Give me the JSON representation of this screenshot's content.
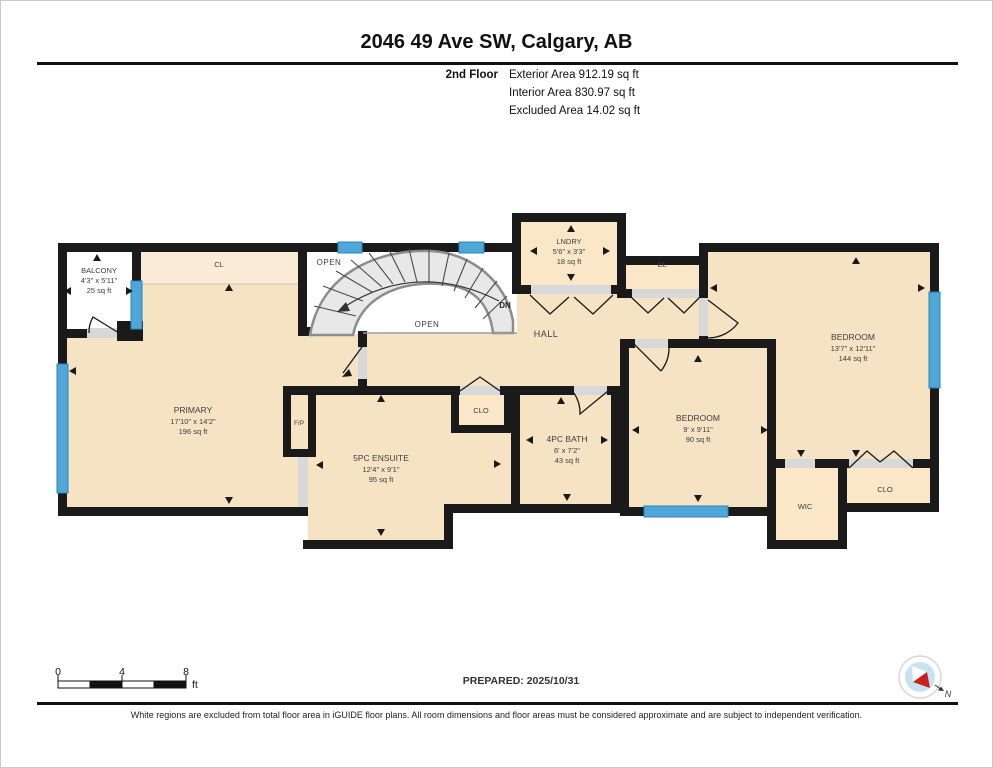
{
  "header": {
    "title": "2046 49 Ave SW, Calgary, AB",
    "floor_label": "2nd Floor",
    "exterior_area": "Exterior Area 912.19 sq ft",
    "interior_area": "Interior Area 830.97 sq ft",
    "excluded_area": "Excluded Area 14.02 sq ft"
  },
  "plan": {
    "rooms": {
      "balcony": {
        "name": "BALCONY",
        "dims": "4'3\" x 5'11\"",
        "area": "25 sq ft"
      },
      "primary": {
        "name": "PRIMARY",
        "dims": "17'10\" x 14'2\"",
        "area": "196 sq ft"
      },
      "ensuite": {
        "name": "5PC ENSUITE",
        "dims": "12'4\" x 9'1\"",
        "area": "95 sq ft"
      },
      "bath": {
        "name": "4PC BATH",
        "dims": "6' x 7'2\"",
        "area": "43 sq ft"
      },
      "bedroom_mid": {
        "name": "BEDROOM",
        "dims": "9' x 9'11\"",
        "area": "90 sq ft"
      },
      "bedroom_right": {
        "name": "BEDROOM",
        "dims": "13'7\" x 12'11\"",
        "area": "144 sq ft"
      },
      "laundry": {
        "name": "LNDRY",
        "dims": "5'6\" x 3'3\"",
        "area": "18 sq ft"
      },
      "hall": {
        "name": "HALL"
      }
    },
    "labels": {
      "cl_primary": "CL",
      "cl_hall": "CL",
      "clo_ensuite": "CLO",
      "clo_bedroom": "CLO",
      "wic": "WIC",
      "fireplace": "F/P",
      "open_upper": "OPEN",
      "open_lower": "OPEN",
      "down": "DN"
    }
  },
  "footer": {
    "scale": {
      "tick0": "0",
      "tick4": "4",
      "tick8": "8",
      "unit": "ft"
    },
    "prepared": "PREPARED: 2025/10/31",
    "compass_north": "N",
    "disclaimer": "White regions are excluded from total floor area in iGUIDE floor plans. All room dimensions and floor areas must be considered approximate and are subject to independent verification."
  },
  "colors": {
    "wall": "#1a1a1a",
    "floor": "#f6e3c4",
    "closet": "#fbe7c8",
    "closet_band": "#f9ebd6",
    "window": "#4fa7d8",
    "stair": "#e8e8e8",
    "threshold": "#d8d8d8",
    "compass_red": "#cc1f1f"
  }
}
